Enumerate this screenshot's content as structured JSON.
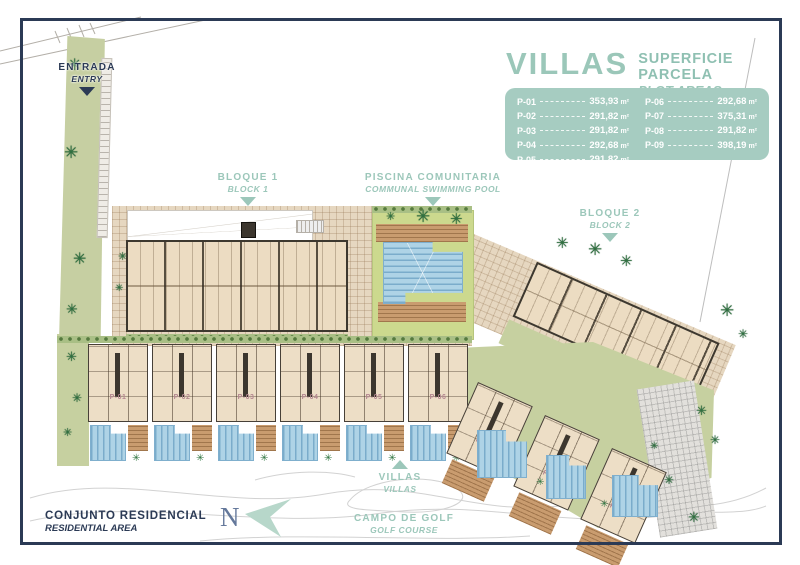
{
  "legend": {
    "title": "VILLAS",
    "subtitle_line1": "SUPERFICIE PARCELA",
    "subtitle_line2": "PLOT AREAS",
    "unit": "m²",
    "panel_color": "#a6ccc1",
    "plots": [
      {
        "id": "P-01",
        "area": "353,93"
      },
      {
        "id": "P-02",
        "area": "291,82"
      },
      {
        "id": "P-03",
        "area": "291,82"
      },
      {
        "id": "P-04",
        "area": "292,68"
      },
      {
        "id": "P-05",
        "area": "291,82"
      },
      {
        "id": "P-06",
        "area": "292,68"
      },
      {
        "id": "P-07",
        "area": "375,31"
      },
      {
        "id": "P-08",
        "area": "291,82"
      },
      {
        "id": "P-09",
        "area": "398,19"
      }
    ]
  },
  "map_labels": {
    "entrance": {
      "line1": "ENTRADA",
      "line2": "ENTRY"
    },
    "block1": {
      "line1": "BLOQUE 1",
      "line2": "BLOCK 1"
    },
    "communal_pool": {
      "line1": "PISCINA COMUNITARIA",
      "line2": "COMMUNAL SWIMMING POOL"
    },
    "block2": {
      "line1": "BLOQUE 2",
      "line2": "BLOCK 2"
    },
    "villas_pointer": {
      "line1": "VILLAS",
      "line2": "VILLAS"
    },
    "golf": {
      "line1": "CAMPO DE GOLF",
      "line2": "GOLF COURSE"
    },
    "residential": {
      "line1": "CONJUNTO RESIDENCIAL",
      "line2": "RESIDENTIAL AREA"
    },
    "north": "N"
  },
  "icons": {
    "palm": "✳"
  },
  "colors": {
    "accent_teal": "#9cc7ba",
    "navy": "#2b3a55",
    "panel_bg": "#a6ccc1",
    "pool_blue": "#aed3e6",
    "lawn_green": "#c6d0a0",
    "paving_tan": "#e6d7c0"
  }
}
